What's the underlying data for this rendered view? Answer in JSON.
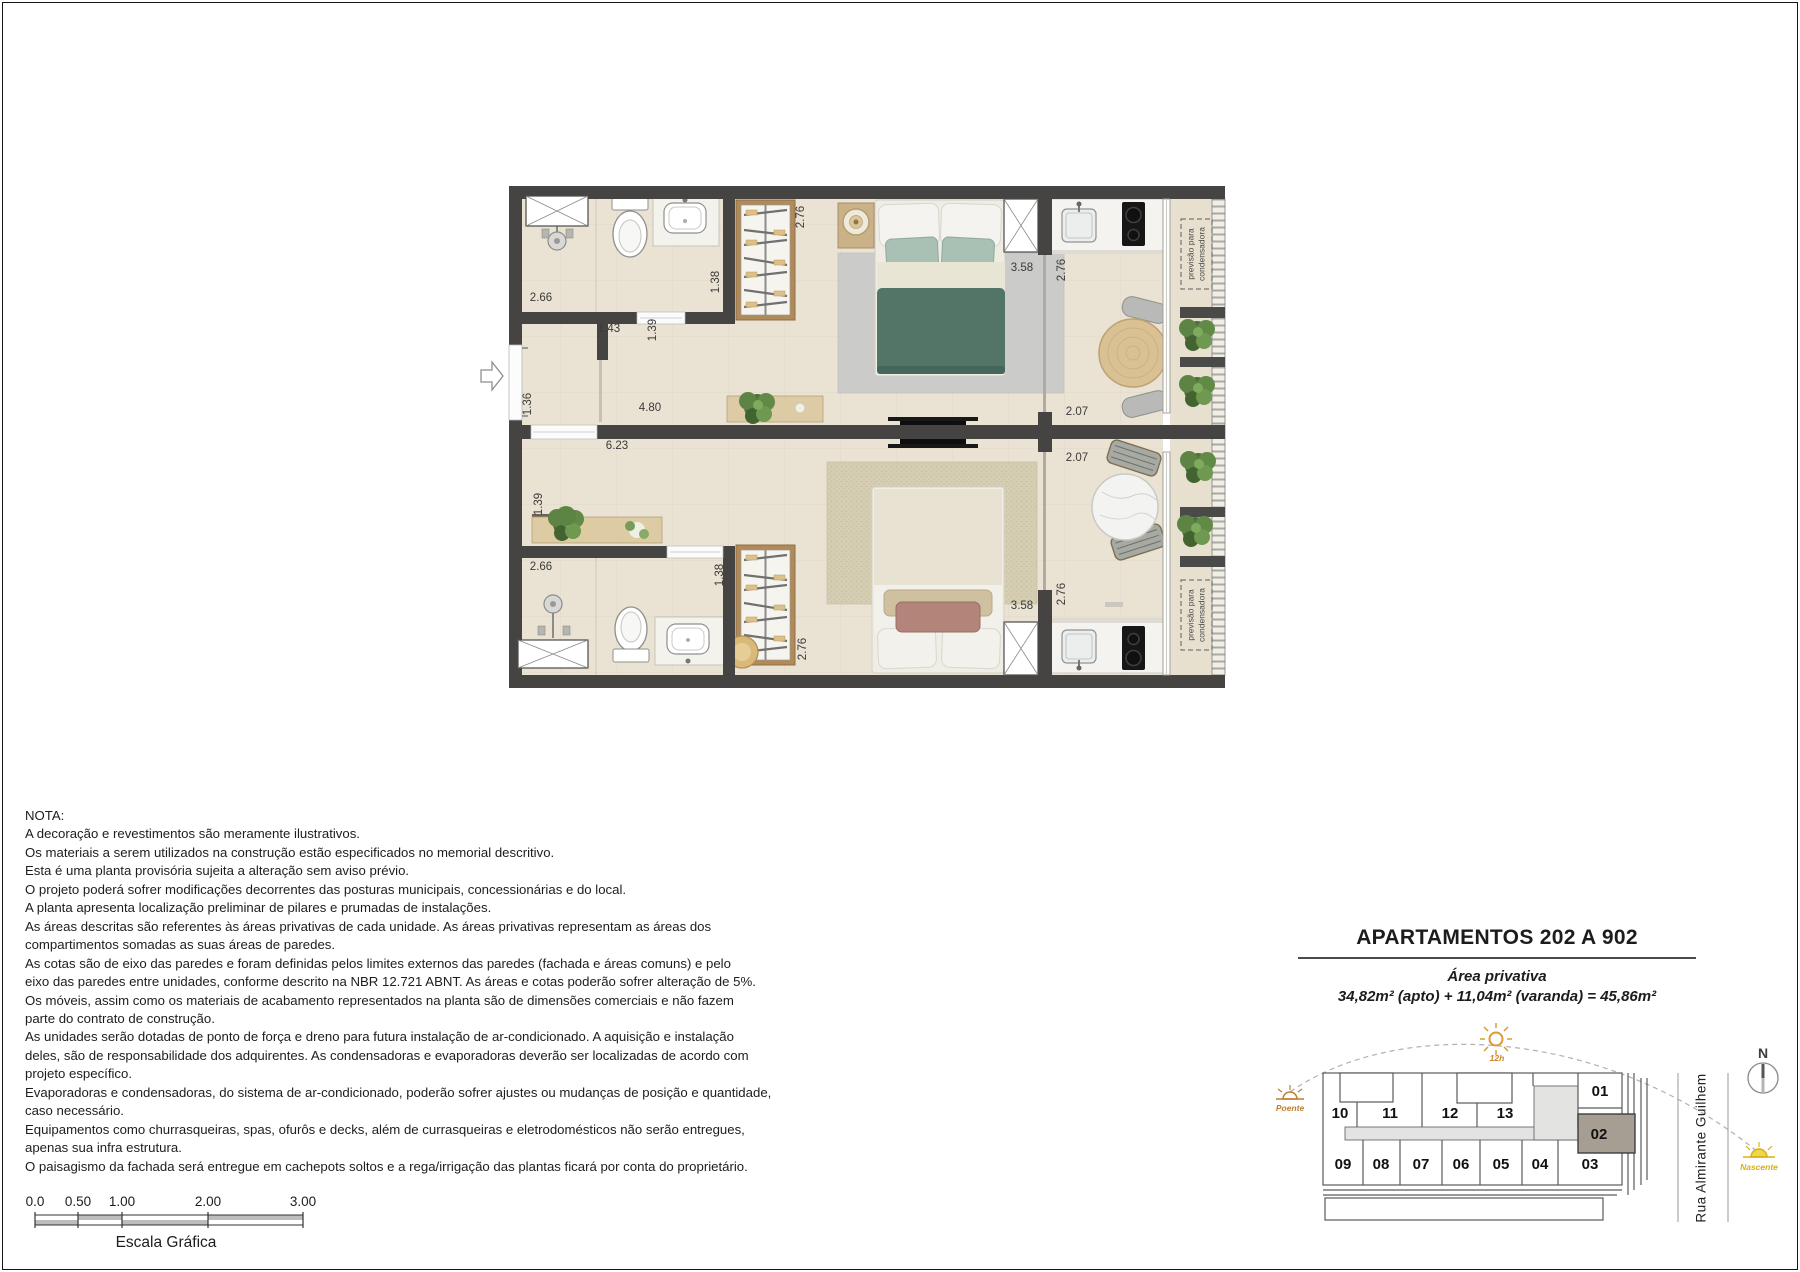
{
  "document": {
    "notes": {
      "heading": "NOTA:",
      "lines": [
        "A decoração e revestimentos são meramente ilustrativos.",
        "Os materiais a serem utilizados na construção estão especificados no memorial descritivo.",
        "Esta é uma planta provisória sujeita a alteração sem aviso prévio.",
        "O projeto poderá sofrer modificações decorrentes das posturas municipais, concessionárias e do local.",
        "A planta apresenta localização preliminar de pilares e prumadas de instalações.",
        "As áreas descritas são referentes às áreas privativas de cada unidade. As áreas privativas representam as áreas dos",
        "compartimentos somadas as suas áreas de paredes.",
        "As cotas são de eixo das paredes e foram definidas pelos limites externos das paredes (fachada e áreas comuns) e pelo",
        "eixo das paredes entre unidades, conforme descrito na NBR 12.721 ABNT. As áreas e cotas poderão sofrer alteração de 5%.",
        "Os móveis, assim como os materiais de acabamento representados na planta são de dimensões comerciais e não fazem",
        "parte do contrato de construção.",
        "As unidades serão dotadas de ponto de força e dreno para futura instalação de ar-condicionado. A aquisição e instalação",
        "deles, são de responsabilidade dos adquirentes. As condensadoras e evaporadoras deverão ser localizadas de acordo com",
        "projeto específico.",
        "Evaporadoras e condensadoras, do sistema de ar-condicionado, poderão sofrer ajustes ou mudanças de posição e quantidade,",
        "caso necessário.",
        "Equipamentos como churrasqueiras, spas, ofurôs e decks, além de currasqueiras e eletrodomésticos não serão entregues,",
        "apenas sua infra estrutura.",
        "O paisagismo da fachada será entregue em cachepots soltos e a rega/irrigação das plantas ficará por conta do proprietário."
      ]
    },
    "title_block": {
      "title": "APARTAMENTOS 202 A 902",
      "subtitle": "Área privativa",
      "area_formula": "34,82m² (apto) + 11,04m² (varanda) = 45,86m²"
    }
  },
  "scale_bar": {
    "ticks": [
      "0.0",
      "0.50",
      "1.00",
      "2.00",
      "3.00"
    ],
    "caption": "Escala Gráfica"
  },
  "floor_plan": {
    "condenser_note": {
      "line1": "previsão para",
      "line2": "condensadora"
    },
    "dims": {
      "t_bath_width": "2.66",
      "t_bath_door": "1.38",
      "t_closet": "2.76",
      "t_hall_width": "1.43",
      "t_hall_depth": "1.39",
      "t_entry": "1.36",
      "t_hall_length": "4.80",
      "t_bed_wall": "3.58",
      "t_kitchen": "2.76",
      "t_balcony_door": "2.07",
      "b_width": "6.23",
      "b_nook": "1.39",
      "b_bath_width": "2.66",
      "b_bath_door": "1.38",
      "b_closet": "2.76",
      "b_bed_wall": "3.58",
      "b_kitchen": "2.76",
      "b_balcony_door": "2.07"
    }
  },
  "key_plan": {
    "units": [
      "01",
      "02",
      "03",
      "04",
      "05",
      "06",
      "07",
      "08",
      "09",
      "10",
      "11",
      "12",
      "13"
    ],
    "highlighted_unit": "02",
    "street": "Rua Almirante Guilhem",
    "compass": "N",
    "sun_path": {
      "noon": "12h",
      "west": "Poente",
      "east": "Nascente"
    }
  },
  "colors": {
    "wall": "#454443",
    "floor": "#eae3d4",
    "balcony_floor": "#e8e0ce",
    "highlight_unit": "#a69e92",
    "accent_orange": "#c07f30",
    "accent_yellow": "#d8b016",
    "teal_bed": "#527568"
  }
}
